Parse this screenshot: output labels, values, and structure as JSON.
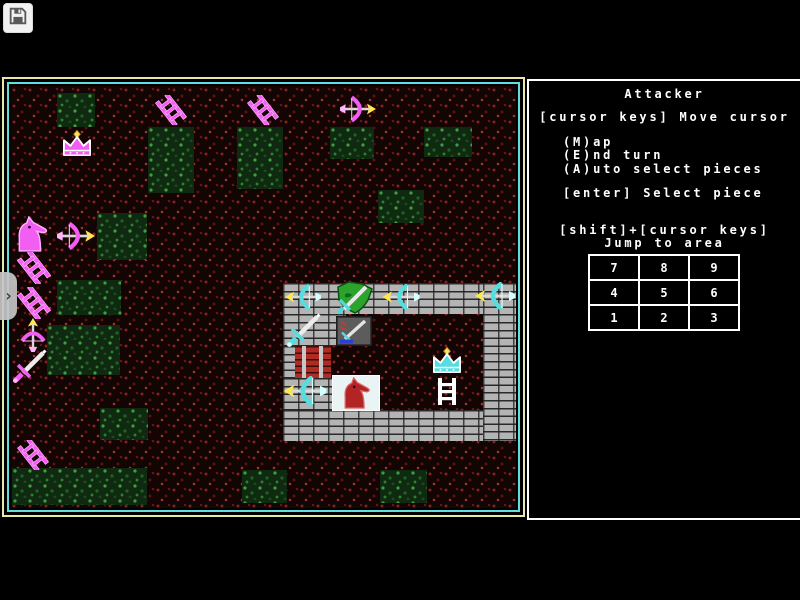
{
  "toolbar": {
    "save_icon": "floppy-disk"
  },
  "drawer": {
    "chevron_icon": "chevron-right",
    "chevron_glyph": "›"
  },
  "sidebar": {
    "title": "Attacker",
    "move_hint": "[cursor keys] Move cursor",
    "menu": [
      "(M)ap",
      "(E)nd turn",
      "(A)uto select pieces"
    ],
    "select_hint": "[enter] Select piece",
    "jump_hint_line1": "[shift]+[cursor keys]",
    "jump_hint_line2": "Jump to area",
    "keypad": [
      [
        "7",
        "8",
        "9"
      ],
      [
        "4",
        "5",
        "6"
      ],
      [
        "1",
        "2",
        "3"
      ]
    ]
  },
  "colors": {
    "attacker": "#ff55ff",
    "defender": "#55ffff",
    "bolt_tip": "#ffe84d",
    "map_border_outer": "#e8e8a8",
    "map_border_inner": "#63dede",
    "brick": "#b4b4b4",
    "gate": "#ad2d24",
    "terrain": "#140505",
    "grass": "#0f2a10",
    "sidebar_border": "#ffffff",
    "text": "#ffffff"
  },
  "map": {
    "green_patches": [
      {
        "x": 46,
        "y": 7,
        "w": 38,
        "h": 34
      },
      {
        "x": 137,
        "y": 41,
        "w": 46,
        "h": 66
      },
      {
        "x": 226,
        "y": 41,
        "w": 46,
        "h": 62
      },
      {
        "x": 319,
        "y": 41,
        "w": 44,
        "h": 32
      },
      {
        "x": 413,
        "y": 41,
        "w": 48,
        "h": 30
      },
      {
        "x": 367,
        "y": 104,
        "w": 46,
        "h": 33
      },
      {
        "x": 86,
        "y": 127,
        "w": 50,
        "h": 47
      },
      {
        "x": 46,
        "y": 194,
        "w": 64,
        "h": 35
      },
      {
        "x": 36,
        "y": 239,
        "w": 73,
        "h": 50
      },
      {
        "x": 89,
        "y": 322,
        "w": 48,
        "h": 32
      },
      {
        "x": 1,
        "y": 382,
        "w": 135,
        "h": 37
      },
      {
        "x": 231,
        "y": 384,
        "w": 45,
        "h": 33
      },
      {
        "x": 369,
        "y": 384,
        "w": 47,
        "h": 33
      }
    ],
    "castle": {
      "walls": [
        {
          "x": 272,
          "y": 197,
          "w": 234,
          "h": 31
        },
        {
          "x": 272,
          "y": 228,
          "w": 63,
          "h": 32
        },
        {
          "x": 272,
          "y": 260,
          "w": 12,
          "h": 32
        },
        {
          "x": 272,
          "y": 292,
          "w": 63,
          "h": 32
        },
        {
          "x": 272,
          "y": 324,
          "w": 234,
          "h": 31
        },
        {
          "x": 472,
          "y": 197,
          "w": 34,
          "h": 158
        }
      ],
      "gate": {
        "x": 284,
        "y": 260,
        "w": 36,
        "h": 32
      }
    },
    "pieces": [
      {
        "name": "attacker-crown",
        "type": "crown",
        "color": "magenta",
        "x": 47,
        "y": 44,
        "w": 38,
        "h": 28
      },
      {
        "name": "attacker-ladder",
        "type": "ladder",
        "color": "magenta",
        "x": 144,
        "y": 9,
        "w": 32,
        "h": 30
      },
      {
        "name": "attacker-ladder",
        "type": "ladder",
        "color": "magenta",
        "x": 236,
        "y": 9,
        "w": 32,
        "h": 30
      },
      {
        "name": "attacker-crossbow",
        "type": "crossbow",
        "color": "magenta",
        "dir": "right",
        "x": 329,
        "y": 8,
        "w": 36,
        "h": 30
      },
      {
        "name": "attacker-knight",
        "type": "knight",
        "color": "magenta",
        "x": 2,
        "y": 130,
        "w": 36,
        "h": 36
      },
      {
        "name": "attacker-crossbow",
        "type": "crossbow",
        "color": "magenta",
        "dir": "right",
        "x": 46,
        "y": 135,
        "w": 38,
        "h": 30
      },
      {
        "name": "attacker-ladder",
        "type": "ladder",
        "color": "magenta",
        "x": 6,
        "y": 166,
        "w": 34,
        "h": 32
      },
      {
        "name": "attacker-ladder",
        "type": "ladder",
        "color": "magenta",
        "x": 6,
        "y": 201,
        "w": 34,
        "h": 32
      },
      {
        "name": "attacker-crossbow",
        "type": "crossbow",
        "color": "magenta",
        "dir": "down",
        "x": 5,
        "y": 232,
        "w": 34,
        "h": 34
      },
      {
        "name": "attacker-sword",
        "type": "sword",
        "color": "magenta",
        "x": 1,
        "y": 262,
        "w": 36,
        "h": 36
      },
      {
        "name": "attacker-ladder",
        "type": "ladder",
        "color": "magenta",
        "x": 5,
        "y": 354,
        "w": 34,
        "h": 30
      },
      {
        "name": "defender-crossbow",
        "type": "crossbow",
        "color": "cyan",
        "dir": "left",
        "x": 274,
        "y": 197,
        "w": 36,
        "h": 28
      },
      {
        "name": "defender-shield",
        "type": "shield",
        "color": "cyan",
        "x": 324,
        "y": 194,
        "w": 40,
        "h": 36
      },
      {
        "name": "defender-crossbow",
        "type": "crossbow",
        "color": "cyan",
        "dir": "left",
        "x": 369,
        "y": 198,
        "w": 42,
        "h": 26
      },
      {
        "name": "defender-crossbow",
        "type": "crossbow",
        "color": "cyan",
        "dir": "left",
        "x": 463,
        "y": 196,
        "w": 42,
        "h": 28
      },
      {
        "name": "defender-sword",
        "type": "sword",
        "color": "cyan",
        "x": 273,
        "y": 226,
        "w": 40,
        "h": 36
      },
      {
        "name": "defender-emblem",
        "type": "emblem",
        "color": "cyan",
        "x": 325,
        "y": 230,
        "w": 36,
        "h": 30
      },
      {
        "name": "defender-crossbow",
        "type": "crossbow",
        "color": "cyan",
        "dir": "left",
        "x": 272,
        "y": 290,
        "w": 44,
        "h": 30
      },
      {
        "name": "defender-knight-selected",
        "type": "knight",
        "color": "red",
        "tile": "white",
        "x": 322,
        "y": 290,
        "w": 46,
        "h": 34
      },
      {
        "name": "defender-crown",
        "type": "crown",
        "color": "cyan",
        "x": 418,
        "y": 261,
        "w": 36,
        "h": 28
      },
      {
        "name": "defender-ladder",
        "type": "ladderV",
        "color": "white",
        "x": 425,
        "y": 292,
        "w": 22,
        "h": 27
      }
    ]
  }
}
